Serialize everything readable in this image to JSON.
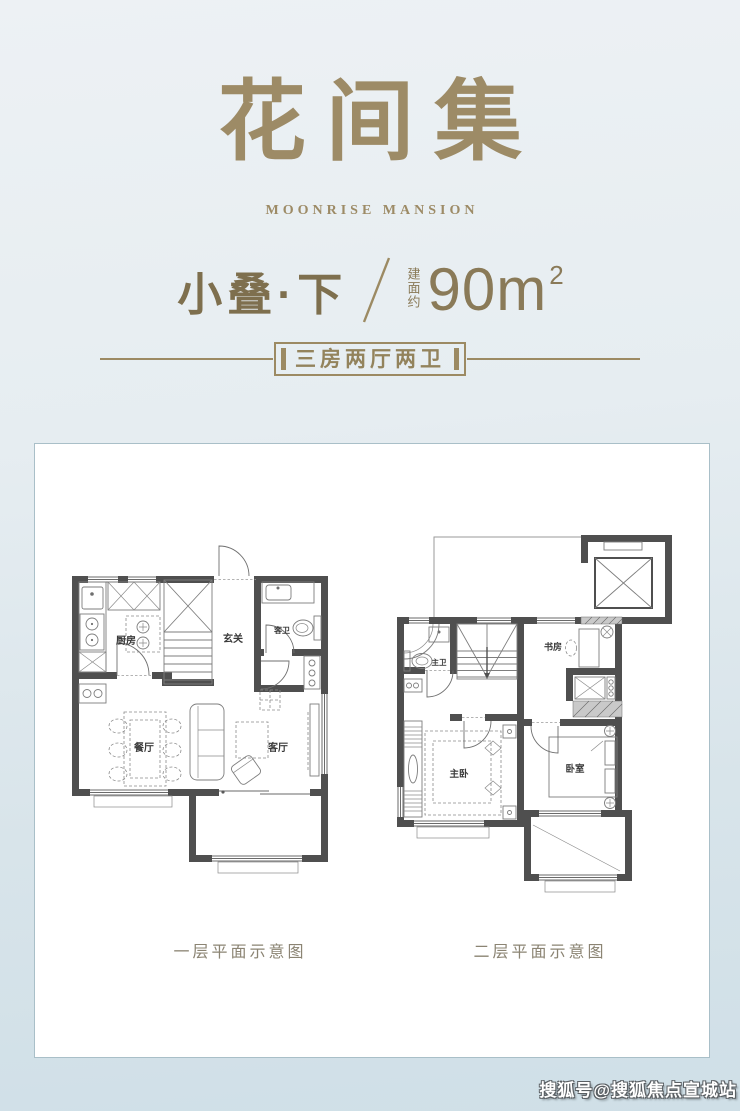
{
  "header": {
    "title": "花间集",
    "subtitle": "MOONRISE MANSION",
    "unit_name": "小叠·下",
    "area_label": "建面约",
    "area_value": "90m",
    "area_exponent": "2",
    "spec_text": "三房两厅两卫"
  },
  "floor1": {
    "caption": "一层平面示意图",
    "rooms": {
      "kitchen": "厨房",
      "foyer": "玄关",
      "guest_bath": "客卫",
      "dining": "餐厅",
      "living": "客厅"
    }
  },
  "floor2": {
    "caption": "二层平面示意图",
    "rooms": {
      "master_bath": "主卫",
      "study": "书房",
      "master_bedroom": "主卧",
      "bedroom": "卧室"
    }
  },
  "watermark": "搜狐号@搜狐焦点宣城站",
  "colors": {
    "accent_gold": "#9c8a63",
    "unit_text": "#7e6f4e",
    "wall_gray": "#4f4f4f",
    "caption_text": "#8b8473",
    "card_background": "#ffffff",
    "page_background_top": "#edf1f4",
    "page_background_bottom": "#cfdfe7"
  }
}
